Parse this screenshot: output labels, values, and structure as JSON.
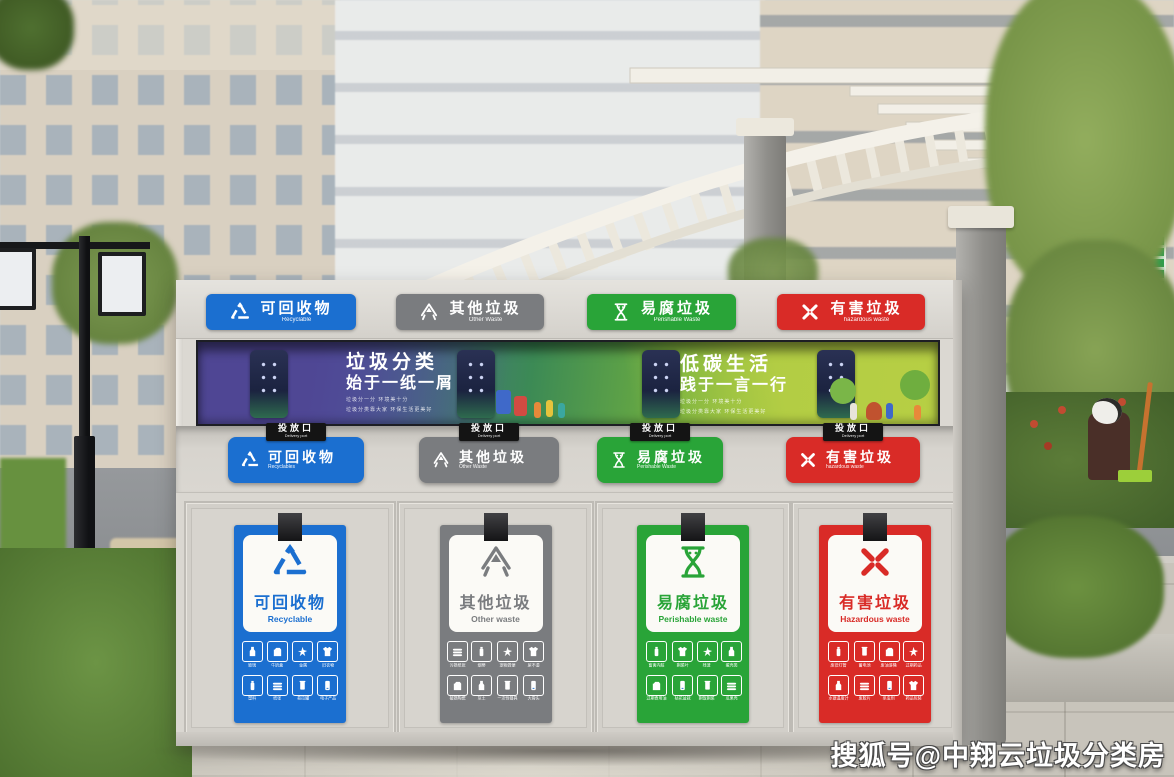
{
  "watermark": "搜狐号@中翔云垃圾分类房",
  "banner": {
    "left": {
      "title": "垃圾分类",
      "subtitle": "始于一纸一屑",
      "tagline1": "垃圾分一分 环境美十分",
      "tagline2": "垃圾分类靠大家 环保生活更美好"
    },
    "right": {
      "title": "低碳生活",
      "subtitle": "践于一言一行",
      "tagline1": "垃圾分一分 环境美十分",
      "tagline2": "垃圾分类靠大家 环保生活更美好"
    }
  },
  "chute_tab": {
    "zh": "投放口",
    "en": "Delivery port"
  },
  "categories": [
    {
      "zh": "可回收物",
      "en_header": "Recyclable",
      "en_chute": "Recyclables",
      "en_poster": "Recyclable",
      "color": "#1b6fd0",
      "icon": "recycle-triangle-icon",
      "items": [
        "玻璃",
        "牛奶盒",
        "金属",
        "旧衣物",
        "塑料",
        "纸张",
        "易拉罐",
        "电子产品"
      ]
    },
    {
      "zh": "其他垃圾",
      "en_header": "Other Waste",
      "en_chute": "Other Waste",
      "en_poster": "Other waste",
      "color": "#7a7c7f",
      "icon": "other-waste-icon",
      "items": [
        "污损纸张",
        "烟蒂",
        "宠物粪便",
        "尿不湿",
        "破损陶瓷",
        "灰土",
        "一次性餐具",
        "大骨头"
      ]
    },
    {
      "zh": "易腐垃圾",
      "en_header": "Perishable Waste",
      "en_chute": "Perishable Waste",
      "en_poster": "Perishable waste",
      "color": "#29a438",
      "icon": "hourglass-icon",
      "items": [
        "畜禽内脏",
        "剩菜叶",
        "残渣",
        "蛋壳类",
        "过期食用油",
        "枯花盆栽",
        "剩饭剩菜",
        "瓜果壳"
      ]
    },
    {
      "zh": "有害垃圾",
      "en_header": "hazardous waste",
      "en_chute": "hazardous waste",
      "en_poster": "Hazardous waste",
      "color": "#d92b27",
      "icon": "hazard-x-icon",
      "items": [
        "废旧灯管",
        "蓄电池",
        "废油漆桶",
        "过期药品",
        "水银温度计",
        "废胶片",
        "杀虫剂",
        "药品包装"
      ]
    }
  ]
}
